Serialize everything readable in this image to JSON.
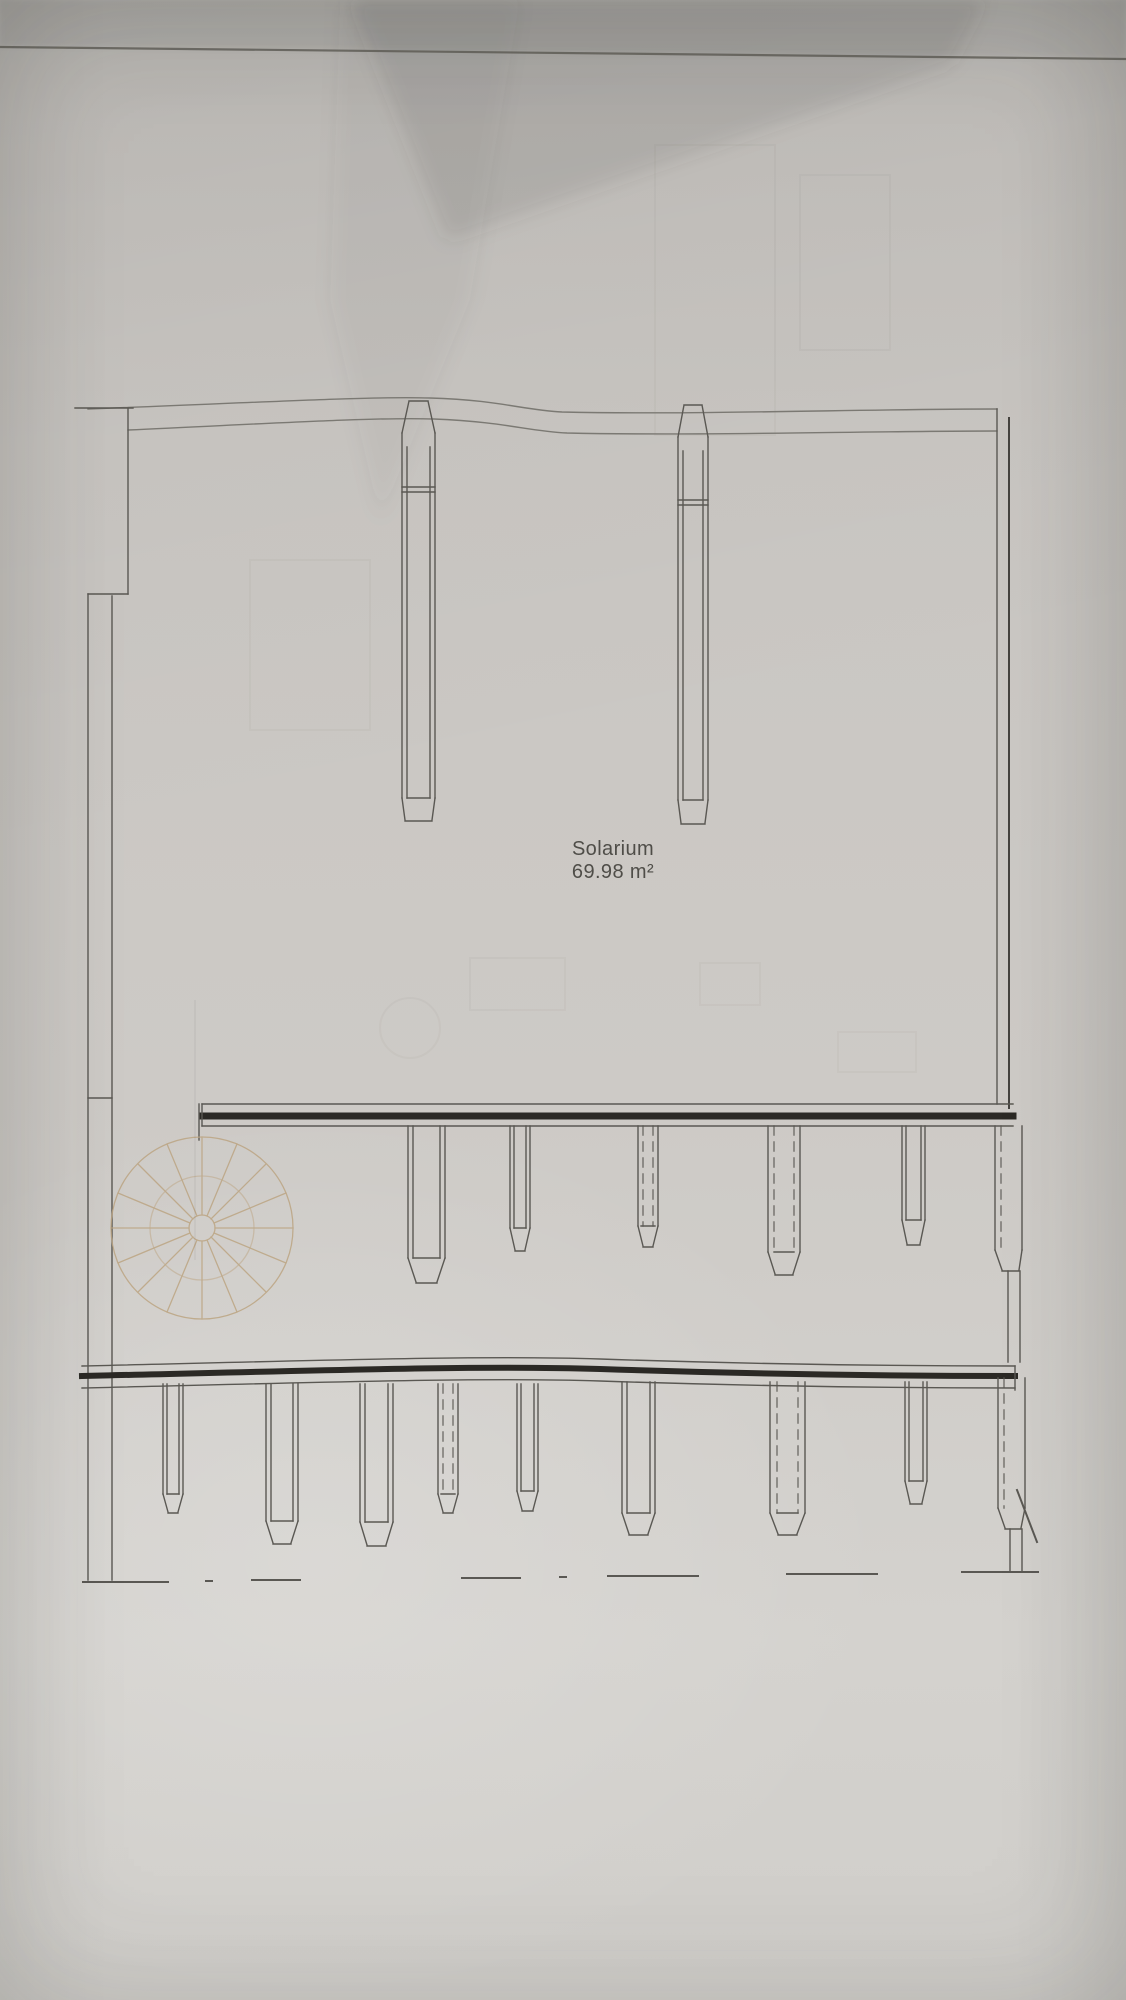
{
  "drawing": {
    "room_label": "Solarium",
    "room_area": "69.98 m²"
  },
  "colors": {
    "paper": "#cbc8c4",
    "ink": "#5a5853",
    "wall_core": "#2b2925",
    "stair_accent": "#bca583",
    "label_text": "#4f4d48"
  }
}
